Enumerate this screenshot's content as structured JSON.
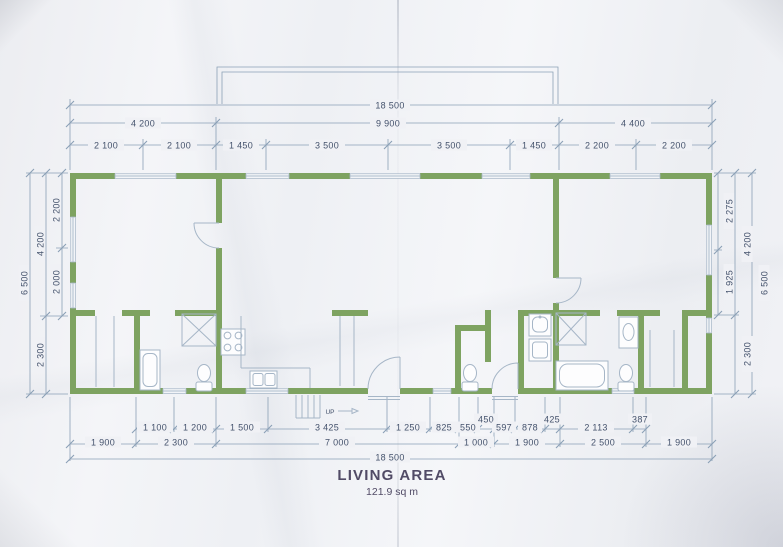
{
  "title": {
    "name": "LIVING AREA",
    "area": "121.9 sq m"
  },
  "stairs": {
    "label": "UP"
  },
  "dimensions": {
    "top_overall": "18 500",
    "top_row2": [
      "4 200",
      "9 900",
      "4 400"
    ],
    "top_row3": [
      "2 100",
      "2 100",
      "1 450",
      "3 500",
      "3 500",
      "1 450",
      "2 200",
      "2 200"
    ],
    "left": {
      "outer": "6 500",
      "middle": [
        "4 200",
        "2 300"
      ],
      "inner": [
        "2 200",
        "2 000"
      ]
    },
    "right": {
      "outer": "6 500",
      "middle": [
        "4 200",
        "2 300"
      ],
      "inner": [
        "2 275",
        "1 925"
      ]
    },
    "bottom_inner": [
      "1 100",
      "1 200",
      "1 500",
      "3 425",
      "1 250",
      "825",
      "550",
      "450",
      "597",
      "878",
      "425",
      "2 113",
      "387"
    ],
    "bottom_row2": [
      "1 900",
      "2 300",
      "7 000",
      "1 000",
      "1 900",
      "2 500",
      "1 900"
    ],
    "bottom_overall": "18 500"
  },
  "colors": {
    "wall": "#7ea361",
    "line": "#a6b6c7",
    "dimline": "#8ba0b6",
    "ink": "#44526c",
    "title-ink": "#514b66",
    "paper": "#f0f1f5"
  }
}
